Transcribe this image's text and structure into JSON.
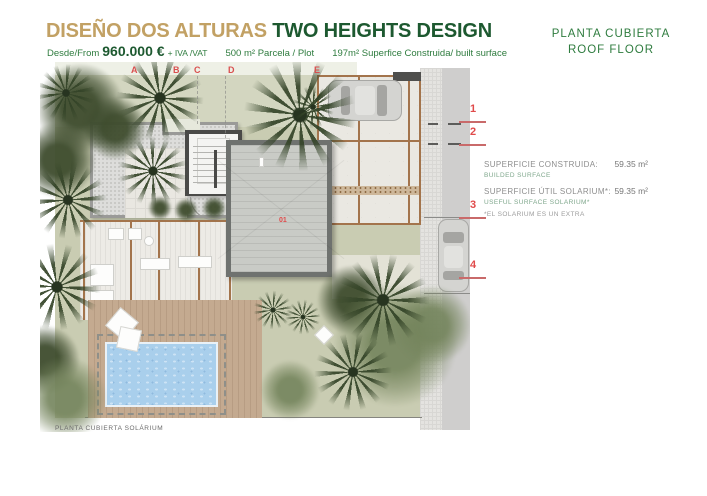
{
  "header": {
    "title_es": "DISEÑO DOS ALTURAS",
    "title_en": "TWO HEIGHTS DESIGN",
    "from_label": "Desde/From",
    "price": "960.000 €",
    "vat": "+ IVA /VAT",
    "plot": "500 m² Parcela / Plot",
    "built": "197m² Superfice Construida/ built surface",
    "plan_es": "PLANTA CUBIERTA",
    "plan_en": "ROOF FLOOR"
  },
  "plan": {
    "caption": "PLANTA CUBIERTA SOLÁRIUM",
    "area_label": "01",
    "grid_letters": [
      "A",
      "B",
      "C",
      "D",
      "E"
    ],
    "grid_numbers": [
      "1",
      "2",
      "3",
      "4"
    ]
  },
  "info": {
    "rows": [
      {
        "label": "SUPERFICIE CONSTRUIDA:",
        "sublabel": "BUILDED SURFACE",
        "value": "59.35 m²"
      },
      {
        "label": "SUPERFICIE ÚTIL SOLARIUM*:",
        "sublabel": "USEFUL SURFACE SOLARIUM*",
        "value": "59.35 m²"
      }
    ],
    "footnote": "*EL SOLARIUM ES UN EXTRA"
  },
  "colors": {
    "title_tan": "#c2a164",
    "title_green": "#1d5930",
    "subtitle_green": "#2f7c3f",
    "marker_red": "#e04b4b",
    "pool_blue": "#a9cfec",
    "deck_tan": "#c4aa90",
    "grass_green": "#c9ccb2",
    "tree_green": "#3e4c2e",
    "pergola_brown": "#a3744c",
    "label_gray": "#8e8e8e",
    "sub_green": "#7fa78c"
  }
}
